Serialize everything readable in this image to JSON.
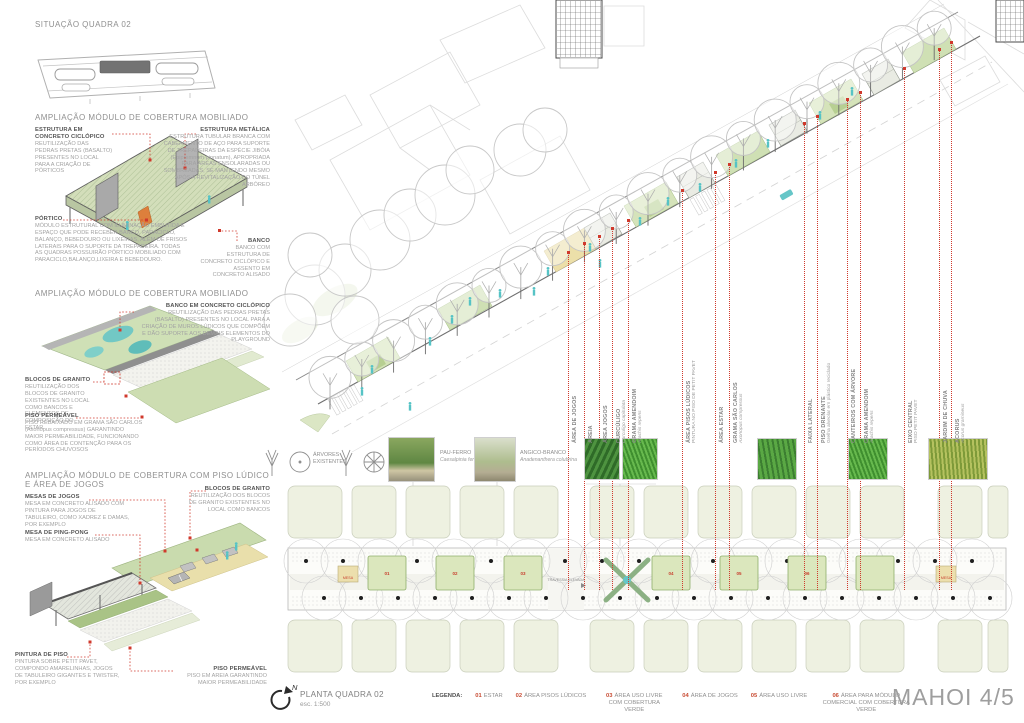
{
  "board": {
    "sheet_title": "MAHOI 4/5",
    "situacao_title": "SITUAÇÃO QUADRA 02",
    "plan": {
      "title": "PLANTA QUADRA 02",
      "scale": "esc. 1:500",
      "north_label": "N"
    },
    "accent_red": "#d0392c",
    "green": "#cfe0b4",
    "teal": "#56c3c5"
  },
  "sections": [
    {
      "title": "AMPLIAÇÃO MÓDULO DE COBERTURA MOBILIADO"
    },
    {
      "title": "AMPLIAÇÃO MÓDULO DE COBERTURA MOBILIADO"
    },
    {
      "title": "AMPLIAÇÃO MÓDULO DE COBERTURA COM PISO LÚDICO E ÁREA DE JOGOS"
    }
  ],
  "annotations": {
    "estrutura_concreto": {
      "heading": "ESTRUTURA EM CONCRETO CICLÓPICO",
      "body": "REUTILIZAÇÃO DAS PEDRAS PRETAS (BASALTO) PRESENTES NO LOCAL PARA A CRIAÇÃO DE PÓRTICOS"
    },
    "estrutura_metalica": {
      "heading": "ESTRUTURA METÁLICA",
      "body": "ESTRUTURA TUBULAR BRANCA COM CABEAMENTO DE AÇO PARA SUPORTE DE TREPADEIRAS DA ESPÉCIE JIBÓIA (Epipremnum pinnatum), APROPRIADA PARA ÁREAS ENSOLARADAS OU SOMBREADAS, SE MANTENDO MESMO APÓS A REVITALIZAÇÃO DO TÚNEL ARBÓREO"
    },
    "portico": {
      "heading": "PÓRTICO",
      "body": "MÓDULO ESTRUTURAL COM ILUMINAÇÃO EMBUTIDA E ESPAÇO QUE PODE RECEBER BANCO, PARACICLO, BALANÇO, BEBEDOURO OU LIXEIRAS, ALÉM DE FRISOS LATERAIS PARA O SUPORTE DA TREPADEIRA. TODAS AS QUADRAS POSSUIRÃO PÓRTICO MOBILIADO COM PARACICLO,BALANÇO,LIXEIRA E BEBEDOURO."
    },
    "banco": {
      "heading": "BANCO",
      "body": "BANCO COM ESTRUTURA DE CONCRETO CICLÓPICO E ASSENTO EM CONCRETO ALISADO"
    },
    "banco_ciclopico": {
      "heading": "BANCO EM CONCRETO CICLÓPICO",
      "body": "REUTILIZAÇÃO DAS PEDRAS PRETAS (BASALTO) PRESENTES NO LOCAL PARA A CRIAÇÃO DE MUROS LÚDICOS QUE COMPÕEM E DÃO SUPORTE AOS DEMAIS ELEMENTOS DO PLAYGROUND"
    },
    "blocos_granito_estar": {
      "heading": "BLOCOS DE GRANITO",
      "body": "REUTILIZAÇÃO DOS BLOCOS DE GRANITO EXISTENTES NO LOCAL COMO BANCOS E ELEMENTOS DE COMPOSIÇÃO DO ESTAR"
    },
    "piso_permeavel_grama": {
      "heading": "PISO PERMEÁVEL",
      "body": "PISO REBAIXADO EM GRAMA SÃO CARLOS (Axonopus compressus) GARANTINDO MAIOR PERMEABILIDADE, FUNCIONANDO COMO ÁREA DE CONTENÇÃO PARA OS PERÍODOS CHUVOSOS"
    },
    "mesas_jogos": {
      "heading": "MESAS DE JOGOS",
      "body": "MESA EM CONCRETO ALISADO COM PINTURA PARA JOGOS DE TABULEIRO, COMO XADREZ E DAMAS, POR EXEMPLO"
    },
    "mesa_ping_pong": {
      "heading": "MESA DE PING-PONG",
      "body": "MESA EM CONCRETO ALISADO"
    },
    "blocos_granito_bancos": {
      "heading": "BLOCOS DE GRANITO",
      "body": "REUTILIZAÇÃO DOS BLOCOS DE GRANITO EXISTENTES NO LOCAL COMO BANCOS"
    },
    "pintura_piso": {
      "heading": "PINTURA DE PISO",
      "body": "PINTURA SOBRE PETIT PAVET, COMPONDO AMARELINHAS, JOGOS DE TABULEIRO GIGANTES E TWISTER, POR EXEMPLO"
    },
    "piso_permeavel_areia": {
      "heading": "PISO PERMEÁVEL",
      "body": "PISO EM AREIA GARANTINDO MAIOR PERMEABILIDADE"
    }
  },
  "veg_legend": {
    "arvores_existentes": "ÁRVORES EXISTENTES",
    "species": [
      {
        "name": "PAU-FERRO",
        "species": "Caesalpinia ferrea"
      },
      {
        "name": "ANGICO-BRANCO",
        "species": "Anadenanthera colubrina"
      }
    ]
  },
  "vertical_labels": [
    {
      "name": "ÁREA DE JOGOS",
      "sub": ""
    },
    {
      "name": "AREIA",
      "sub": ""
    },
    {
      "name": "ÁREA JOGOS",
      "sub": ""
    },
    {
      "name": "CURCÚLIGO",
      "sub": "Curculigo capitulata"
    },
    {
      "name": "GRAMA AMENDOIM",
      "sub": "Arachis repens"
    },
    {
      "name": "ÁREA PISOS LÚDICOS",
      "sub": "PINTURA NO PISO DE PETIT PAVET"
    },
    {
      "name": "ÁREA ESTAR",
      "sub": ""
    },
    {
      "name": "GRAMA SÃO CARLOS",
      "sub": "Axonopus compressus"
    },
    {
      "name": "FAIXA LATERAL",
      "sub": ""
    },
    {
      "name": "PISO DRENANTE",
      "sub": "Grelha alveolar em plástico reciclado"
    },
    {
      "name": "CANTEIROS COM ÁRVORE",
      "sub": ""
    },
    {
      "name": "GRAMA AMENDOIM",
      "sub": "Arachis repens"
    },
    {
      "name": "EIXO CENTRAL",
      "sub": "PISO PETIT PAVET"
    },
    {
      "name": "JARDIM DE CHUVA",
      "sub": ""
    },
    {
      "name": "ACORUS",
      "sub": "Acorus gramineus"
    }
  ],
  "plan_labels": {
    "mesa": "MESA",
    "travessia": "TRAVESSIA ELEVADA",
    "module_tags": [
      "01",
      "02",
      "03",
      "04",
      "05",
      "06"
    ]
  },
  "legend": {
    "label": "LEGENDA:",
    "items": [
      {
        "num": "01",
        "text": "ESTAR"
      },
      {
        "num": "02",
        "text": "ÁREA PISOS LÚDICOS"
      },
      {
        "num": "03",
        "text": "ÁREA USO LIVRE COM COBERTURA VERDE"
      },
      {
        "num": "04",
        "text": "ÁREA DE JOGOS"
      },
      {
        "num": "05",
        "text": "ÁREA USO LIVRE"
      },
      {
        "num": "06",
        "text": "ÁREA PARA MÓDULO COMERCIAL COM COBERTURA VERDE"
      }
    ]
  }
}
